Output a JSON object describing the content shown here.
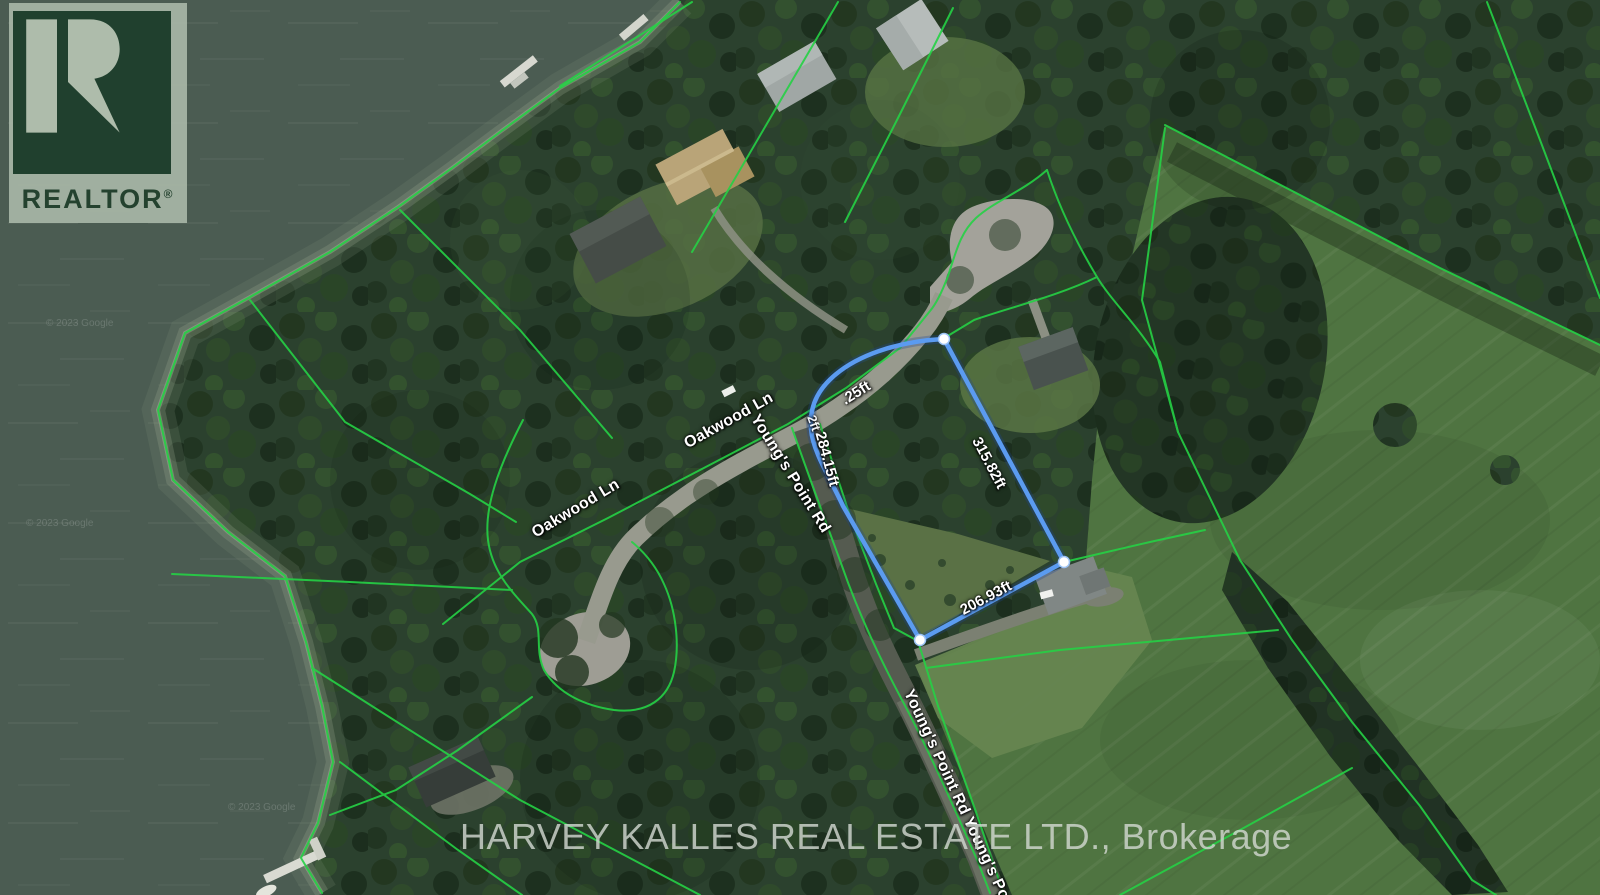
{
  "branding": {
    "realtor_logo": {
      "text": "REALTOR",
      "registered_mark": "®"
    },
    "brokerage_watermark": "HARVEY KALLES REAL ESTATE LTD., Brokerage"
  },
  "attribution": {
    "tile_credit": "© 2023 Google"
  },
  "map": {
    "street_labels": {
      "oakwood_west": "Oakwood Ln",
      "oakwood_east": "Oakwood Ln",
      "youngs_point_upper": "Young's Point Rd",
      "youngs_point_lower": "Young's Point Rd Young's Poi"
    },
    "property_boundary": {
      "color": "#5b9bf0",
      "vertex_color": "#ffffff",
      "measurements": {
        "right_side": "315.82ft",
        "bottom_side": "206.93ft",
        "left_side": "284.15ft",
        "top_side": ".25ft",
        "corner_fragment": "2ft"
      }
    },
    "colors": {
      "water": "#4b5c52",
      "forest": "#2b412e",
      "field": "#4f7441",
      "parcel_line_green": "#25d145",
      "road_light": "#989a8e",
      "road_dark": "#555b50"
    }
  }
}
